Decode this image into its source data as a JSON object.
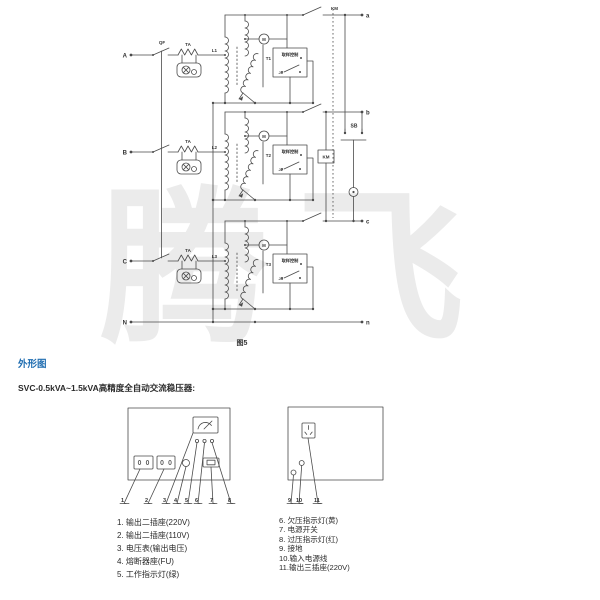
{
  "watermark": {
    "text": "腾飞",
    "color": "#ebebeb"
  },
  "circuit": {
    "caption": "图5",
    "breaker": "QF",
    "ct": "TA",
    "contactor": "KM",
    "button": "SB",
    "motor": "M",
    "controller": "取样控制",
    "neutral_in": "N",
    "neutral_out": "n",
    "phases": [
      {
        "input": "A",
        "output": "a",
        "coil": "L1",
        "transformer": "T1",
        "relay": "J1"
      },
      {
        "input": "B",
        "output": "b",
        "coil": "L2",
        "transformer": "T2",
        "relay": "J2"
      },
      {
        "input": "C",
        "output": "c",
        "coil": "L3",
        "transformer": "T3",
        "relay": "J3"
      }
    ]
  },
  "section": {
    "heading": "外形图",
    "heading_color": "#1e6cb0",
    "subtitle": "SVC-0.5kVA~1.5kVA高精度全自动交流稳压器:"
  },
  "panels": {
    "front_callouts": [
      "1",
      "2",
      "3",
      "4",
      "5",
      "6",
      "7",
      "8"
    ],
    "rear_callouts": [
      "9",
      "10",
      "11"
    ]
  },
  "legend": {
    "left": [
      "1. 输出二插座(220V)",
      "2. 输出二插座(110V)",
      "3. 电压表(输出电压)",
      "4. 熔断器座(FU)",
      "5. 工作指示灯(绿)"
    ],
    "right": [
      "6. 欠压指示灯(黄)",
      "7. 电源开关",
      "8. 过压指示灯(红)",
      "9. 接地",
      "10.输入电源线",
      "11.输出三插座(220V)"
    ]
  },
  "colors": {
    "line": "#4a4a4a",
    "text": "#333333",
    "heading": "#1e6cb0",
    "watermark": "#ebebeb"
  }
}
